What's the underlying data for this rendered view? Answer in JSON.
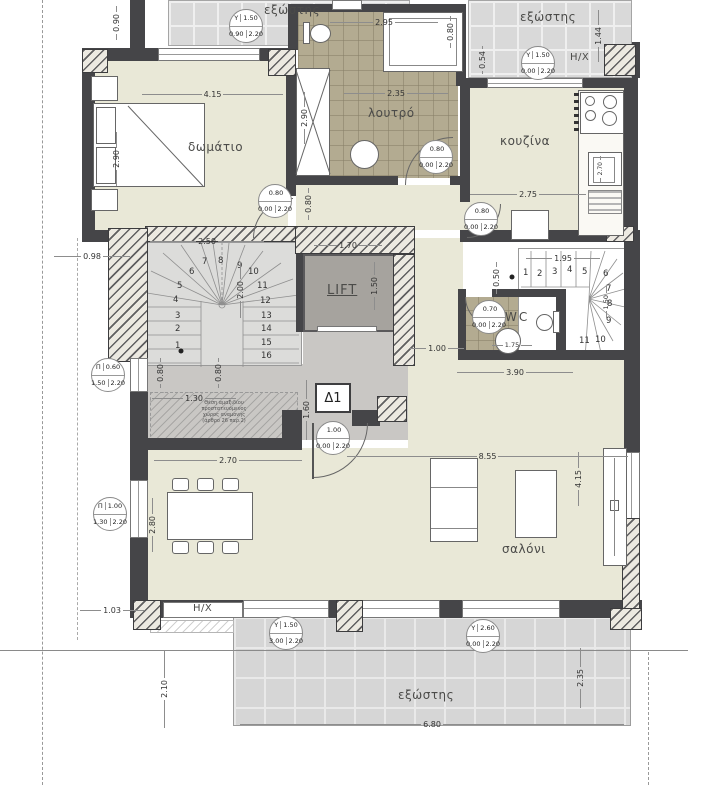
{
  "rooms": {
    "bedroom": "δωμάτιο",
    "bathroom": "λουτρό",
    "kitchen": "κουζίνα",
    "wc": "WC",
    "living_room": "σαλόνι",
    "lift": "LIFT",
    "balcony_top_left": "εξώστης",
    "balcony_top_right": "εξώστης",
    "terrace": "εξώστης"
  },
  "labels": {
    "hx_top": "H/X",
    "hx_bottom": "H/X",
    "apartment": "Δ1",
    "note_l1": "Θέση αμαξιδίου",
    "note_l2": "προστατευόμενος",
    "note_l3": "χώρος αναμονής",
    "note_l4": "(άρθρο 26 παρ.2)"
  },
  "dimensions": {
    "balcony_tl_depth": "0.90",
    "bedroom_width": "4.15",
    "bed_length": "2.90",
    "bath_top": "2.95",
    "tub_width": "0.80",
    "bath_width": "2.35",
    "bath_height": "2.90",
    "tr_054": "0.54",
    "tr_144": "1.44",
    "kitchen_width": "2.75",
    "sink_270": "2.70",
    "left_098": "0.98",
    "stair_width": "2.50",
    "stair_height": "2.00",
    "lift_width": "1.70",
    "lift_height": "1.50",
    "rstair_width": "1.95",
    "rstair_050": "0.50",
    "rstair_150": "1.50",
    "hall_080": "0.80",
    "corridor_100": "1.00",
    "hall_390": "3.90",
    "vest_080a": "0.80",
    "vest_080b": "0.80",
    "vest_160": "1.60",
    "wheel_130": "1.30",
    "wc_175": "1.75",
    "din_270": "2.70",
    "liv_855": "8.55",
    "din_280": "2.80",
    "liv_415": "4.15",
    "bl_103": "1.03",
    "bl_210": "2.10",
    "terr_235": "2.35",
    "terr_680": "6.80"
  },
  "markers": [
    {
      "code": "Y",
      "w": "1.50",
      "s": "0.90",
      "h": "2.20"
    },
    {
      "code": "Y",
      "w": "1.50",
      "s": "0.00",
      "h": "2.20"
    },
    {
      "code": "",
      "w": "0.80",
      "s": "0.00",
      "h": "2.20"
    },
    {
      "code": "",
      "w": "0.80",
      "s": "0.00",
      "h": "2.20"
    },
    {
      "code": "",
      "w": "0.80",
      "s": "0.00",
      "h": "2.20"
    },
    {
      "code": "Π",
      "w": "0.60",
      "s": "1.50",
      "h": "2.20"
    },
    {
      "code": "",
      "w": "0.70",
      "s": "0.00",
      "h": "2.20"
    },
    {
      "code": "",
      "w": "1.00",
      "s": "0.00",
      "h": "2.20"
    },
    {
      "code": "Π",
      "w": "1.00",
      "s": "1.30",
      "h": "2.20"
    },
    {
      "code": "Y",
      "w": "1.50",
      "s": "3.00",
      "h": "2.20"
    },
    {
      "code": "Y",
      "w": "2.60",
      "s": "0.00",
      "h": "2.20"
    }
  ],
  "stairs": {
    "left_steps": [
      "1",
      "2",
      "3",
      "4",
      "5",
      "6",
      "7",
      "8",
      "9",
      "10",
      "11",
      "12",
      "13",
      "14",
      "15",
      "16"
    ],
    "right_steps": [
      "1",
      "2",
      "3",
      "4",
      "5",
      "6",
      "7",
      "8",
      "9",
      "10",
      "11"
    ]
  }
}
